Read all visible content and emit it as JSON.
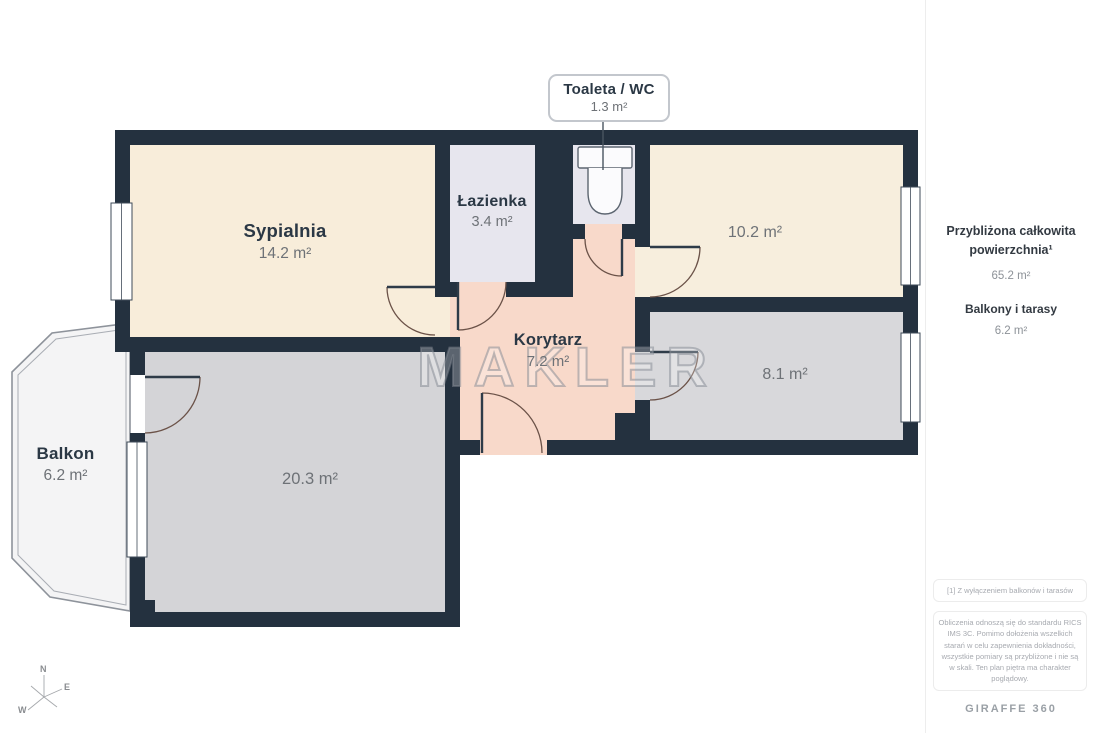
{
  "watermark": "MAKLER",
  "callout": {
    "title": "Toaleta / WC",
    "area": "1.3 m²"
  },
  "rooms": {
    "sypialnia": {
      "name": "Sypialnia",
      "area": "14.2 m²"
    },
    "lazienka": {
      "name": "Łazienka",
      "area": "3.4 m²"
    },
    "korytarz": {
      "name": "Korytarz",
      "area": "7.2 m²"
    },
    "room_10_2": {
      "area": "10.2 m²"
    },
    "room_8_1": {
      "area": "8.1 m²"
    },
    "room_20_3": {
      "area": "20.3 m²"
    },
    "balkon": {
      "name": "Balkon",
      "area": "6.2 m²"
    }
  },
  "sidebar": {
    "total_label": "Przybliżona całkowita powierzchnia¹",
    "total_value": "65.2 m²",
    "balconies_label": "Balkony i tarasy",
    "balconies_value": "6.2 m²",
    "footnote": "[1] Z wyłączeniem balkonów i tarasów",
    "disclaimer": "Obliczenia odnoszą się do standardu RICS IMS 3C. Pomimo dołożenia wszelkich starań w celu zapewnienia dokładności, wszystkie pomiary są przybliżone i nie są w skali. Ten plan piętra ma charakter poglądowy.",
    "brand": "GIRAFFE 360"
  },
  "compass": {
    "n": "N",
    "e": "E",
    "w": "W"
  },
  "colors": {
    "wall": "#24313f",
    "room_cream": "#f8edda",
    "room_lavender": "#e7e6ee",
    "room_salmon": "#f8d9ca",
    "room_grey": "#d4d4d7",
    "balcony_fill": "#f4f4f5",
    "label_dark": "#2b3845",
    "label_grey": "#6e7277"
  }
}
